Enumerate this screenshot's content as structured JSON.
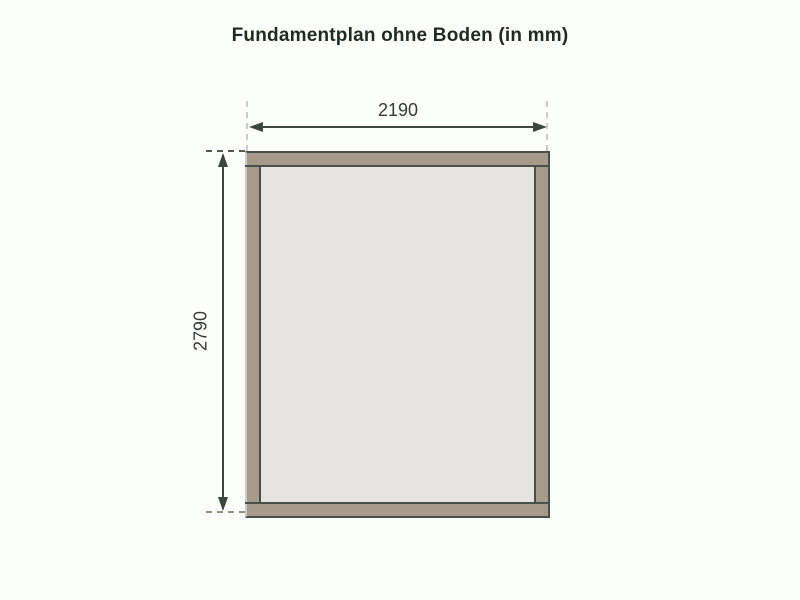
{
  "title": "Fundamentplan ohne Boden (in mm)",
  "drawing": {
    "type": "foundation-plan",
    "unit": "mm",
    "horizontal_dimension": "2190",
    "vertical_dimension": "2790",
    "colors": {
      "beam": "#a79a8d",
      "interior": "#e6e3e0",
      "outline": "#49504a",
      "dimension": "#3d463d",
      "text": "#343c34",
      "title_text": "#1f2a20",
      "dash_light": "#cbcbcb",
      "dash_dark": "#55584c",
      "dash_brown": "#9a8c7f",
      "background": "#fcfffc"
    }
  }
}
